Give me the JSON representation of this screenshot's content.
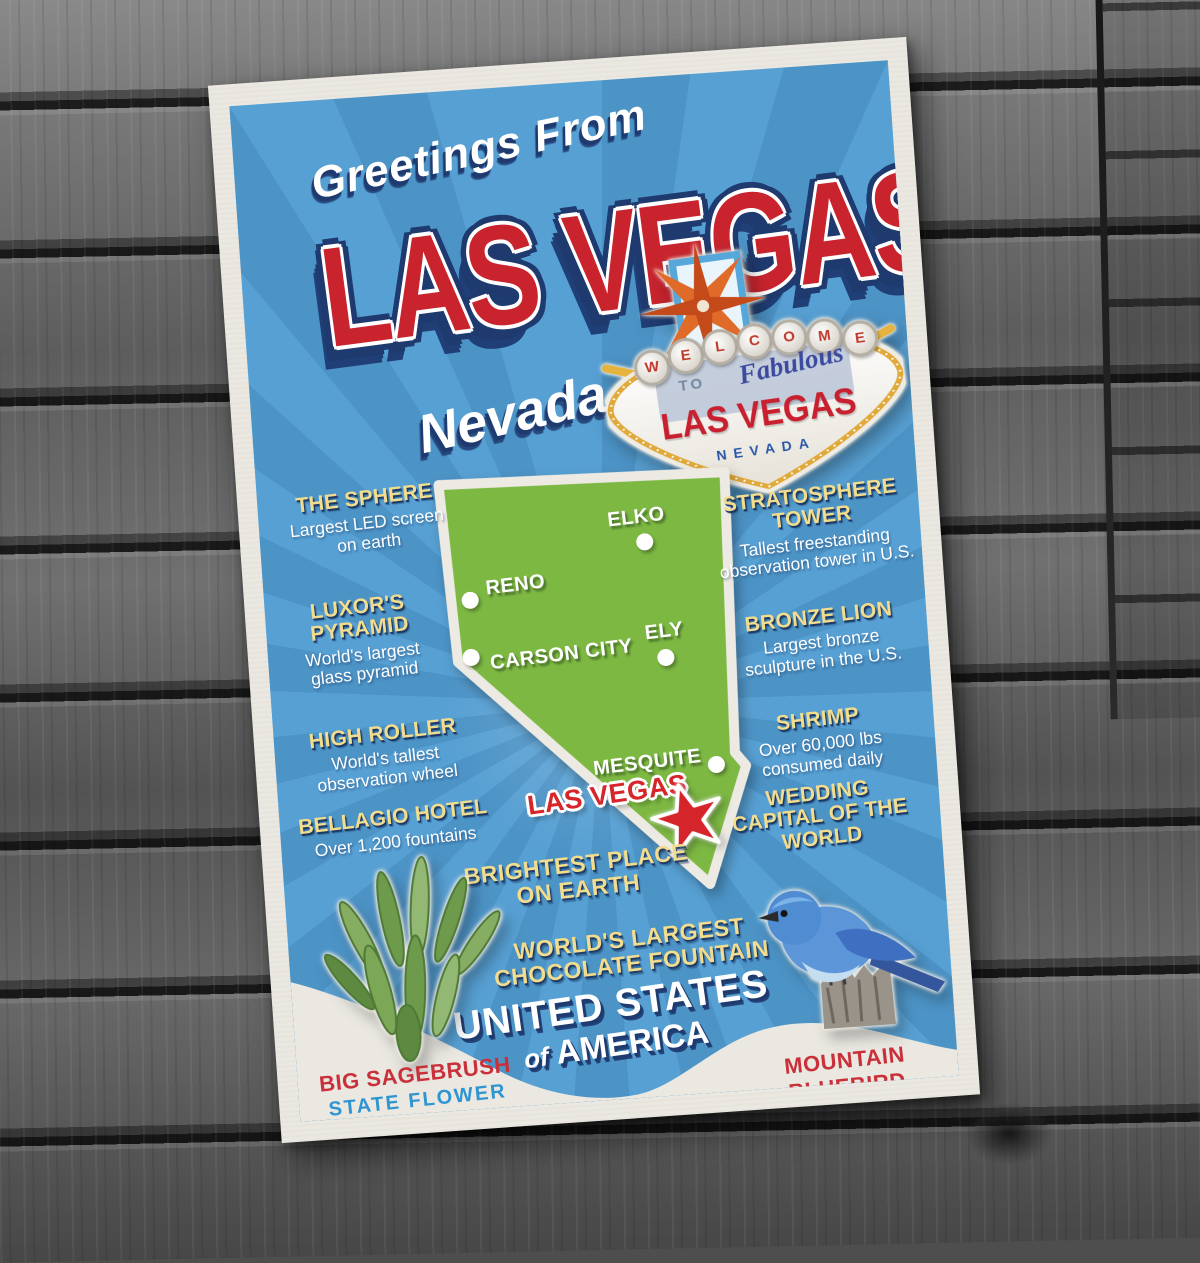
{
  "scene": {
    "description": "Greetings From Las Vegas Nevada travel postcard lying on weathered gray wood planks"
  },
  "postcard": {
    "greeting": "Greetings From",
    "title": "LAS VEGAS",
    "state_script": "Nevada",
    "sign": {
      "letters": [
        "W",
        "E",
        "L",
        "C",
        "O",
        "M",
        "E"
      ],
      "to": "TO",
      "fabulous": "Fabulous",
      "city": "LAS VEGAS",
      "state": "NEVADA"
    },
    "facts_left": [
      {
        "heading": "THE SPHERE",
        "body": "Largest LED screen on earth"
      },
      {
        "heading": "LUXOR'S PYRAMID",
        "body": "World's largest glass pyramid"
      },
      {
        "heading": "HIGH ROLLER",
        "body": "World's tallest observation wheel"
      },
      {
        "heading": "BELLAGIO HOTEL",
        "body": "Over 1,200 fountains"
      }
    ],
    "facts_right": [
      {
        "heading": "STRATOSPHERE TOWER",
        "body": "Tallest freestanding observation tower in U.S."
      },
      {
        "heading": "BRONZE LION",
        "body": "Largest bronze sculpture in the U.S."
      },
      {
        "heading": "SHRIMP",
        "body": "Over 60,000 lbs consumed daily"
      },
      {
        "heading": "WEDDING CAPITAL OF THE WORLD",
        "body": ""
      }
    ],
    "map": {
      "state_shape": "Nevada",
      "cities": [
        {
          "name": "ELKO"
        },
        {
          "name": "RENO"
        },
        {
          "name": "ELY"
        },
        {
          "name": "CARSON CITY"
        },
        {
          "name": "MESQUITE"
        }
      ],
      "highlight": {
        "name": "LAS VEGAS",
        "marker": "red star"
      }
    },
    "extra_facts": [
      {
        "text": "BRIGHTEST PLACE ON EARTH"
      },
      {
        "text": "WORLD'S LARGEST CHOCOLATE FOUNTAIN"
      }
    ],
    "country": {
      "line1": "UNITED STATES",
      "of": "of",
      "line2": "AMERICA"
    },
    "state_flower": {
      "name": "BIG SAGEBRUSH",
      "label": "STATE FLOWER"
    },
    "state_bird": {
      "name": "MOUNTAIN BLUEBIRD",
      "label": "STATE BIRD"
    }
  },
  "icons": {
    "las_vegas_star": "red five-point star marker",
    "sign_starburst": "orange eight-point starburst",
    "sagebrush_sticker": "green big sagebrush plant",
    "bluebird_sticker": "mountain bluebird perched on wooden post"
  },
  "colors": {
    "card_blue": "#4c93c6",
    "ray_blue": "#57a0d3",
    "map_green": "#7db843",
    "heading_yellow": "#f2dc8e",
    "title_red": "#c9242e",
    "navy": "#1e3a6e",
    "label_red": "#c9303a",
    "label_blue": "#2e95d2",
    "paper": "#eae8e1",
    "wood_gray": "#6a6a6a"
  }
}
